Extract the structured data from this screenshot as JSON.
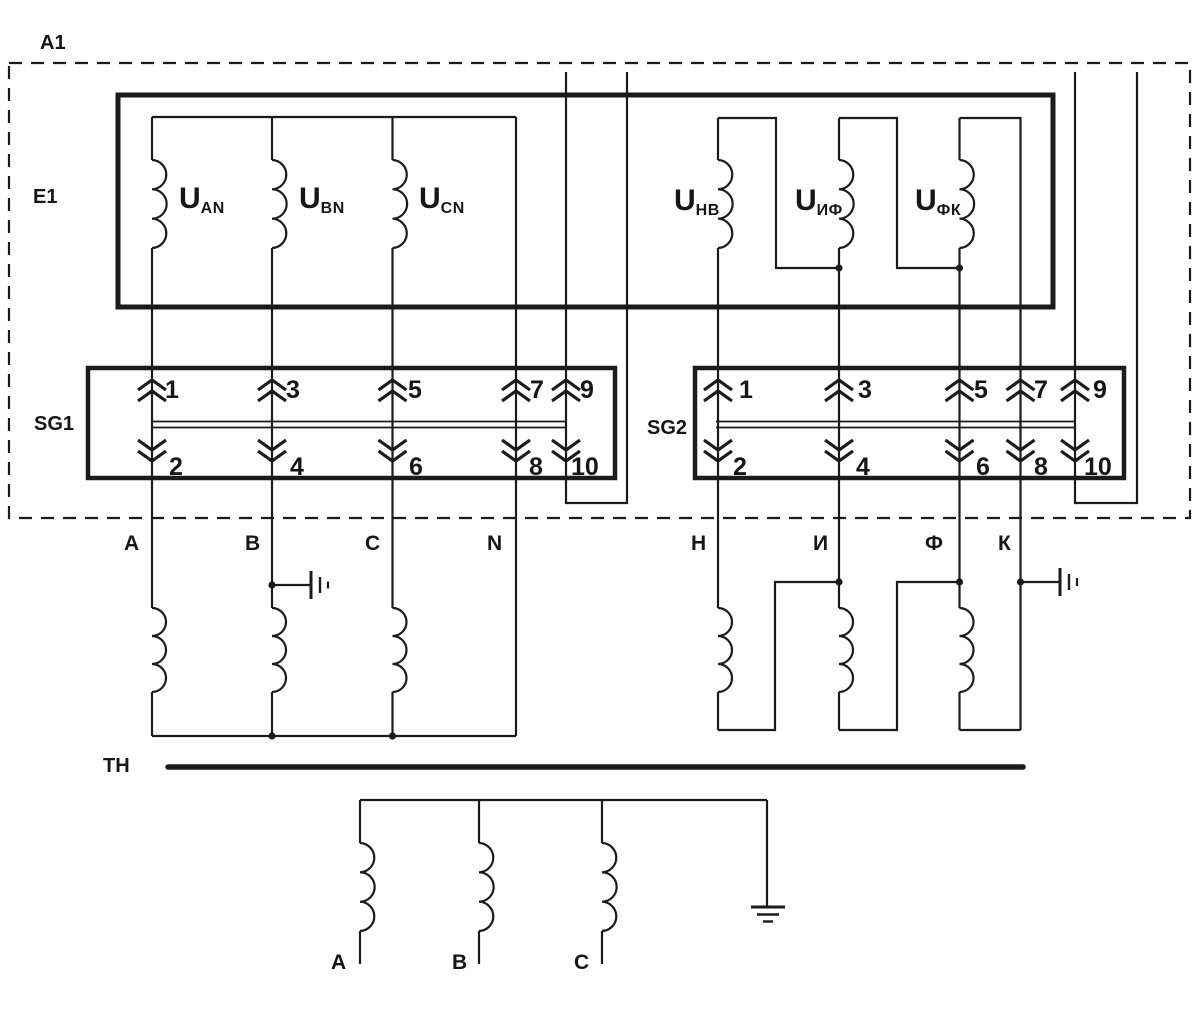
{
  "colors": {
    "line": "#1b1b1b",
    "background": "#ffffff"
  },
  "module": {
    "label": "A1"
  },
  "e1": {
    "label": "E1",
    "windings": [
      {
        "main": "U",
        "sub": "AN"
      },
      {
        "main": "U",
        "sub": "BN"
      },
      {
        "main": "U",
        "sub": "CN"
      },
      {
        "main": "U",
        "sub": "НВ"
      },
      {
        "main": "U",
        "sub": "ИФ"
      },
      {
        "main": "U",
        "sub": "ФК"
      }
    ]
  },
  "sg1": {
    "label": "SG1",
    "top_terminals": [
      "1",
      "3",
      "5",
      "7",
      "9"
    ],
    "bottom_terminals": [
      "2",
      "4",
      "6",
      "8",
      "10"
    ]
  },
  "sg2": {
    "label": "SG2",
    "top_terminals": [
      "1",
      "3",
      "5",
      "7",
      "9"
    ],
    "bottom_terminals": [
      "2",
      "4",
      "6",
      "8",
      "10"
    ]
  },
  "conductors": {
    "star": [
      "A",
      "B",
      "C",
      "N"
    ],
    "open_delta": [
      "Н",
      "И",
      "Ф",
      "К"
    ]
  },
  "transformer": {
    "label": "ТН",
    "primary_phases": [
      "А",
      "В",
      "С"
    ]
  }
}
